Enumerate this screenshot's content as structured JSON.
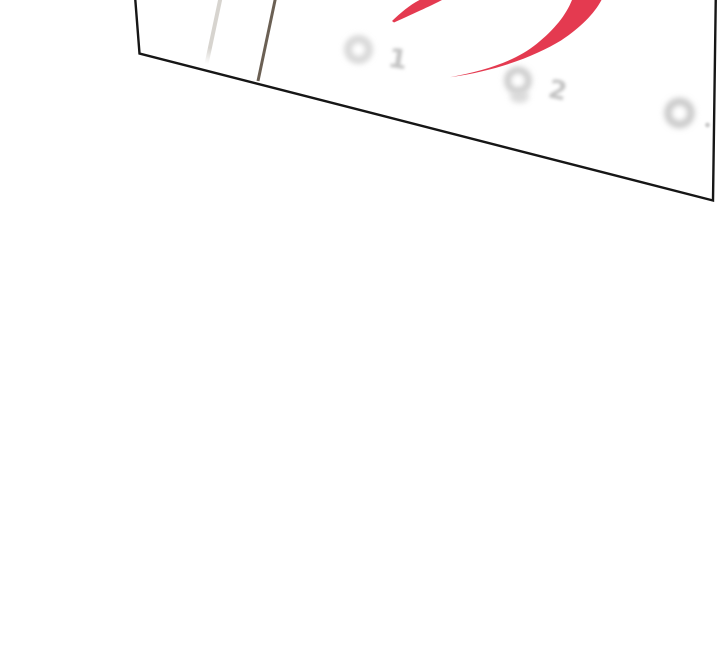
{
  "page": {
    "background_color": "#ffffff"
  },
  "panel": {
    "fill_color": "#ffffff",
    "outline_color": "#161616"
  },
  "calendar": {
    "fold_line_light_color": "#d7d4cf",
    "fold_line_dark_color": "#6b6054",
    "glyph_color": "#d6d6d6",
    "glyph_color_darker": "#c9c9c9",
    "digit_color": "#c3c3c3",
    "date_1": "1",
    "date_2": "2"
  },
  "marker": {
    "color": "#e43a50"
  }
}
